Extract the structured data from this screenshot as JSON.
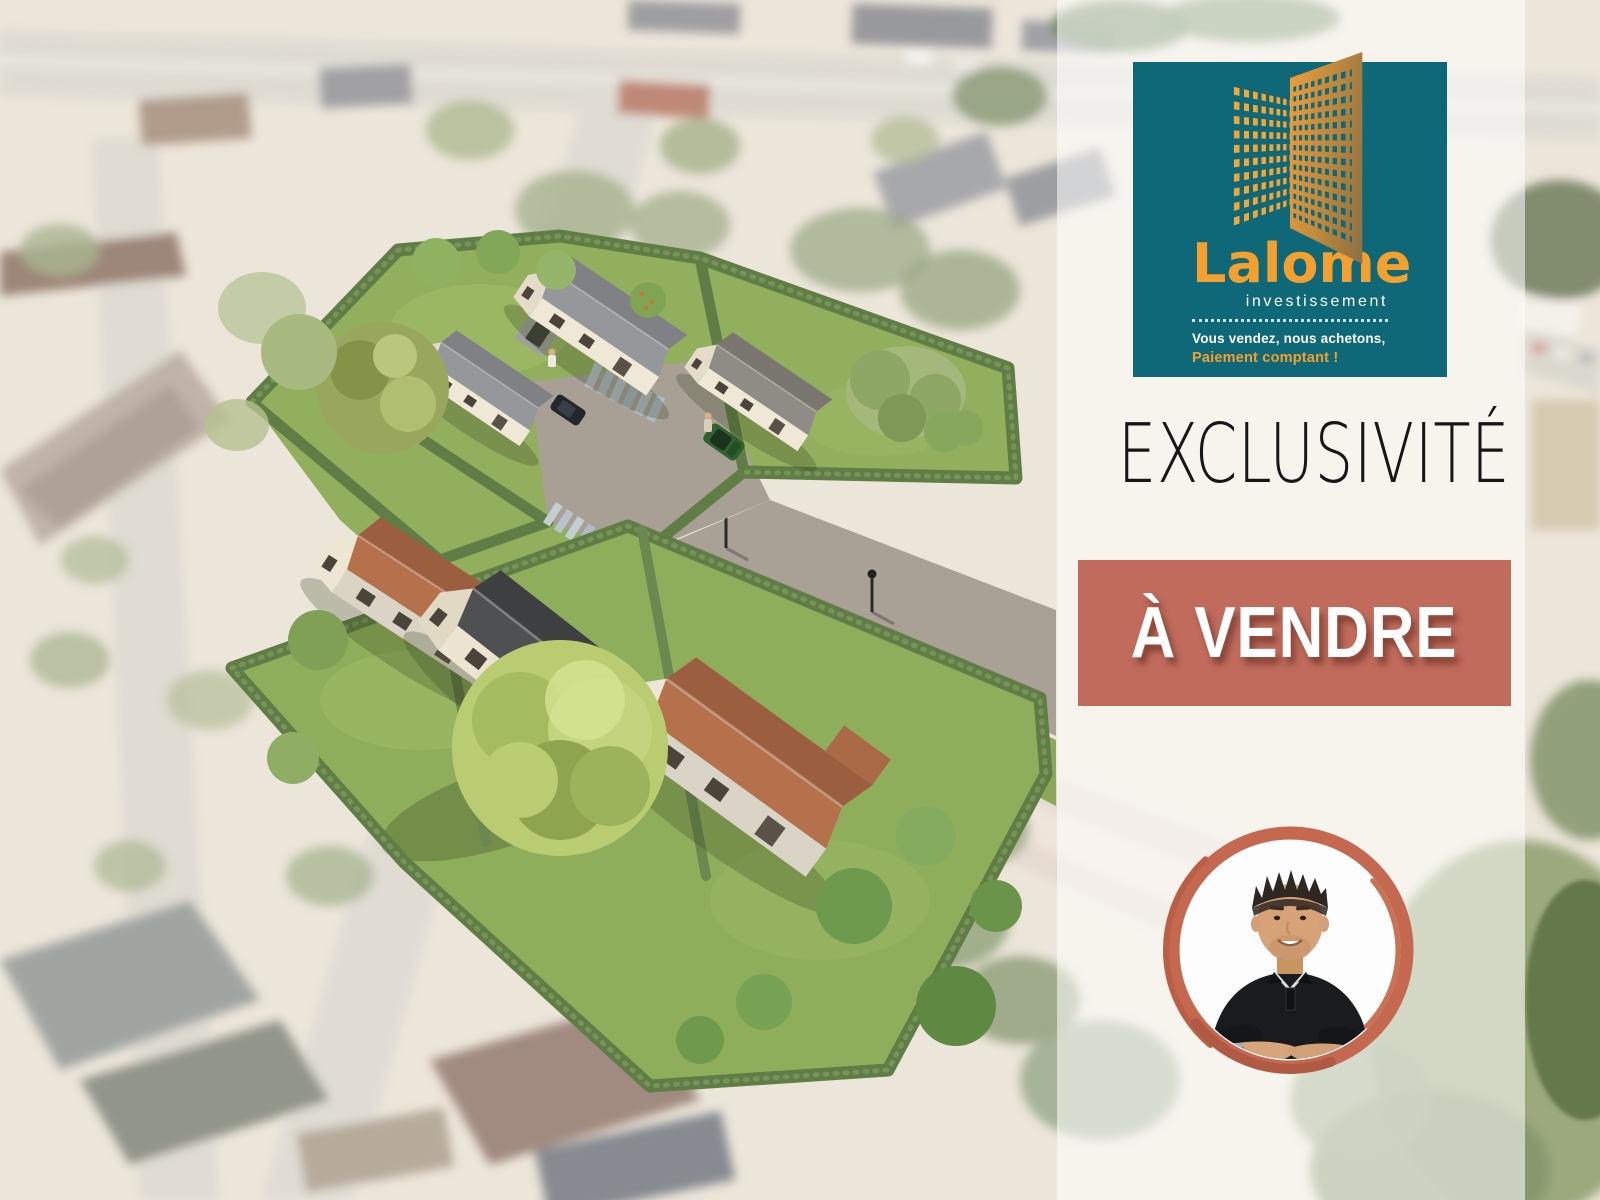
{
  "brand_card": {
    "name": "Lalome",
    "subtitle": "investissement",
    "tagline_line1": "Vous vendez, nous achetons,",
    "tagline_line2": "Paiement comptant !",
    "bg_color": "#0E6877",
    "accent_color": "#F5A02E",
    "building_icon": "building-windows-perspective-icon"
  },
  "headline": {
    "text": "EXCLUSIVITÉ",
    "color": "#161616"
  },
  "sale_banner": {
    "text": "À VENDRE",
    "bg_color": "#C06B5C",
    "text_color": "#FFFFFF"
  },
  "agent": {
    "photo_icon": "agent-portrait-photo",
    "ring_color": "#C4684F"
  },
  "scene": {
    "render_icon": "aerial-3d-development-render",
    "palette": {
      "lawn": "#90AE5C",
      "hedge": "#5F7D44",
      "tile_roof": "#B5714B",
      "dark_roof": "#4F5051",
      "wall": "#EEE6D2",
      "driveway": "#A8A094"
    }
  }
}
